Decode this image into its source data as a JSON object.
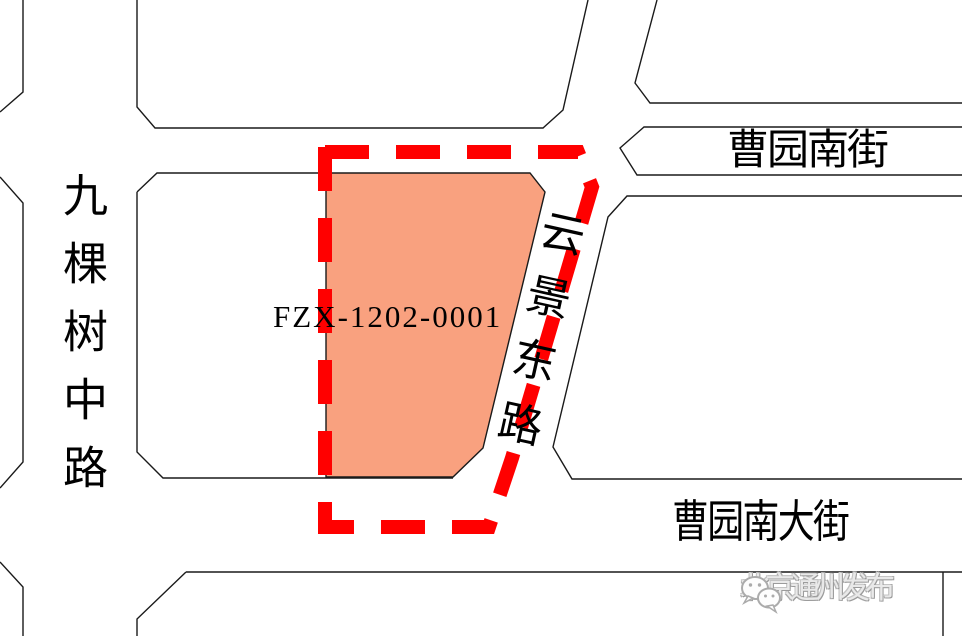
{
  "map": {
    "background_color": "#ffffff",
    "line_color": "#1a1a1a",
    "parcel": {
      "id": "FZX-1202-0001",
      "fill_color": "#F9A17F",
      "dashed_border_color": "#FF0000"
    },
    "roads": {
      "west": {
        "name": "九棵树中路",
        "orientation": "vertical"
      },
      "north": {
        "name": "曹园南街",
        "orientation": "horizontal"
      },
      "east": {
        "name": "云景东路",
        "orientation": "diagonal"
      },
      "south": {
        "name": "曹园南大街",
        "orientation": "horizontal"
      }
    },
    "watermark": {
      "icon": "wechat-icon",
      "text": "北京通州发布",
      "color": "#b5b5b5"
    }
  }
}
